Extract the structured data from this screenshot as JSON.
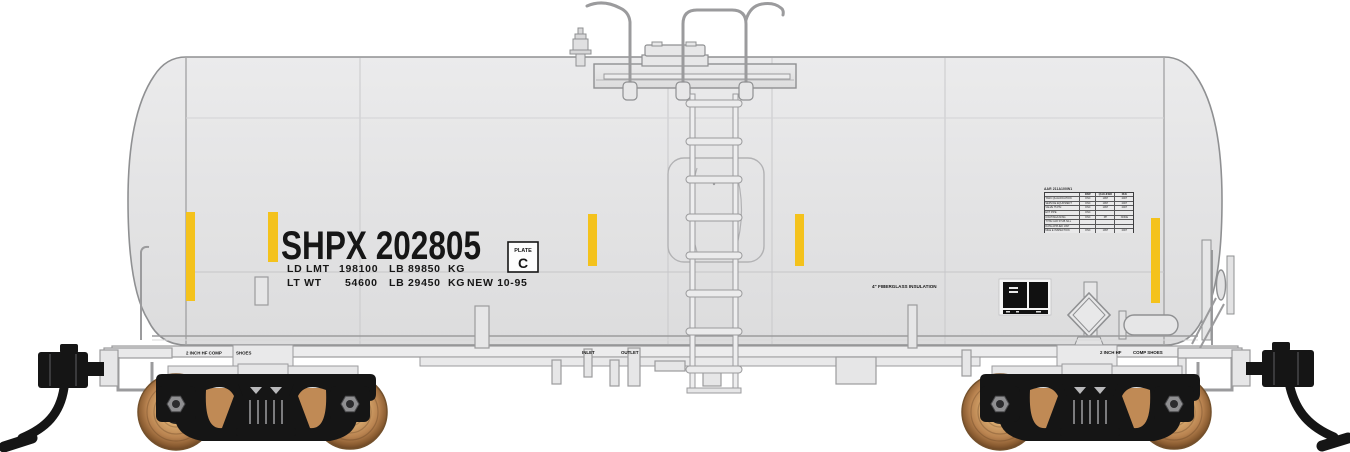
{
  "colors": {
    "background": "#ffffff",
    "tank_body": "#e4e4e5",
    "tank_outline": "#8f9092",
    "stripe_yellow": "#f4c21c",
    "marking_text": "#161616",
    "truck_black": "#151515",
    "wheel_copper": "#bb8350"
  },
  "markings": {
    "reporting_mark": "SHPX 202805",
    "load_limit": {
      "label": "LD LMT",
      "pounds": "198100",
      "pounds_unit": "LB",
      "kilos": "89850",
      "kilos_unit": "KG"
    },
    "light_weight": {
      "label": "LT WT",
      "pounds": "54600",
      "pounds_unit": "LB",
      "kilos": "29450",
      "kilos_unit": "KG",
      "built_date": "NEW 10-95"
    },
    "plate_badge": {
      "top": "PLATE",
      "letter": "C"
    },
    "insulation_note": "4\" FIBERGLASS INSULATION",
    "inlet_label": "INLET",
    "outlet_label": "OUTLET",
    "brake_shoe_left": {
      "part1": "2 INCH HF COMP",
      "part2": "SHOES"
    },
    "brake_shoe_right": {
      "part1": "2 INCH HF",
      "part2": "COMP SHOES"
    },
    "qualification_stencil": {
      "title": "AAR 211A100W1",
      "columns": [
        "",
        "INSP",
        "QUALIFIED",
        "DUE"
      ],
      "rows": [
        [
          "TANK QUALIFICATION",
          "ONC",
          "1997",
          "2007"
        ],
        [
          "SERVICE EQUIPMENT",
          "ONC",
          "1997",
          "2007"
        ],
        [
          "VALVE 75 PSI",
          "ONC",
          "1997",
          "2007"
        ],
        [
          "EXT PIPE",
          "ONC",
          "",
          ""
        ],
        [
          "COATING/LINING",
          "ONC",
          "PP",
          "NONE"
        ],
        [
          "TYPE CAR STUB SILL",
          "",
          "",
          ""
        ],
        [
          "DATE APPLIED 1997",
          "",
          "",
          ""
        ],
        [
          "MILE E INSPECTION",
          "ONC",
          "1997",
          "2007"
        ]
      ]
    }
  }
}
